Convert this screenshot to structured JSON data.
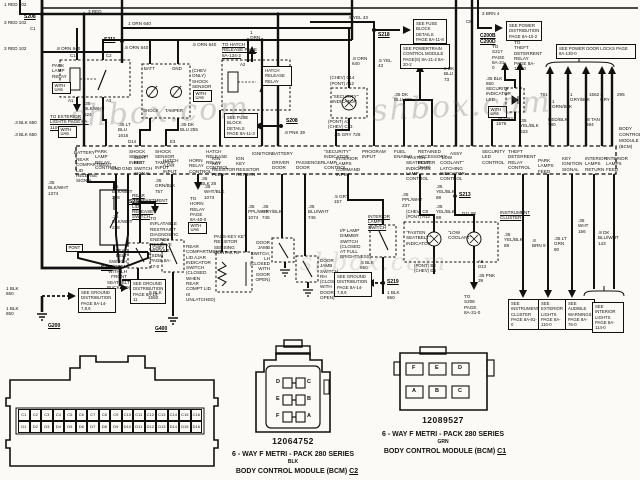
{
  "watermark": "shbox.com",
  "splices": {
    "s208a": "S208",
    "s208b": "S208",
    "s211": "S211",
    "s217": "S217",
    "s218": "S218",
    "s219": "S219",
    "s233": "S233",
    "s213": "S213",
    "g200": "G200",
    "g400": "G400"
  },
  "pin_ids": {
    "c1": "C1",
    "c1b": "C1",
    "c2": "C2",
    "a1": "A1",
    "a3": "A3",
    "a2": "A2",
    "d14": "D14",
    "e3": "E3",
    "c8": "C8",
    "c200b": "C200B",
    "c200d": "C200D",
    "chev_c14": "(CHEV) C14",
    "pont_a12": "(PONT) A12",
    "pont_a3": "(PONT) A3",
    "chev_c13": "(CHEV) C13",
    "chev_c8": "(CHEV) C8",
    "pont_a12b": "(PONT) A12",
    "d11_88": "D11  88",
    "pont_b3": "(PONT) B3",
    "chev_d4": "(CHEV) D4",
    "a5": "A5",
    "d13": "D13"
  },
  "wire_labels": {
    "red102_1": "1 RED 102",
    "red102_3a": "3 RED 102",
    "red102_3b": "3 RED 102",
    "red3": "3 RED",
    "orn640_1": "1 ORN 640",
    "orn640_8a": ".8 ORN 640",
    "orn640_8b": ".8 ORN 640",
    "orn640_5": ".5 ORN 640",
    "orn640_8c": ".8 ORN 640",
    "orn1": "1 ORN",
    "blkwht624": ".35 BLK/WHT 624",
    "blk650_3a": ".3 BLK 650",
    "blk650_3b": ".3 BLK 650",
    "ltblu1616": ".35 LT BLU 1616",
    "dkblu255": ".35 DK BLU 255",
    "pnk39_8": ".8 PNK 39",
    "yel43_5a": ".5 YEL 43",
    "yel43_5b": ".5 YEL 43",
    "gry728": ".35 GRY 728",
    "dkblu229": ".35 DK BLU 229",
    "dkblu73_2": "2 DK BLU 73",
    "brn4_3": "3 BRN 4",
    "blk650_35": ".35 BLK 650",
    "gry1579": ".35 GRY 1579",
    "yelblk633": ".35 YEL/BLK 633",
    "c781": "781",
    "ornblk1": "1 ORN/BLK",
    "redblk780": "RED/BLK 780",
    "gryblk1": "1 GRY/BLK",
    "c1562": "1562",
    "tan694": ".8 TAN 694",
    "gry1": "1 GRY",
    "c295": "295",
    "blkwht1374": ".35 BLK/WHT 1374",
    "blkwht238a": ".35 BLK/WHT 238",
    "blkwht238b": ".35 BLK/WHT 238",
    "grnblk757": ".35 GRN/BLK 757",
    "blk28": ".35 BLK 28",
    "whtblk1073": ".35 WHT/BLK 1073",
    "pplwht1074": ".35 PPL/WHT 1074",
    "gryblk745": ".35 GRY/BLK 745",
    "bluwht746": ".35 BLU/WHT 746",
    "gry157": ".5 GRY 157",
    "blk650_5a": ".5 BLK 650",
    "blk650_1a": "1 BLK 650",
    "blk650_1b": "1 BLK 650",
    "blk650_1c": "1 BLK 650",
    "blk1550": ".5 BLK 1550",
    "pplwht237": ".35 PPL/WHT 237",
    "yelblk88a": ".35 YEL/BLK 88",
    "yelblk88b": ".35 YEL/BLK 88",
    "yelblk88c": ".35 YEL/BLK 88",
    "pnk39": ".35 PNK 39",
    "brn9": ".8 BRN 9",
    "ltgrn80": ".35 LT GRN 80",
    "wht156": ".35 WHT 156",
    "dkbluwht143": ".8 DK BLU/WHT 143"
  },
  "notes": {
    "to_exterior_lights": "TO EXTERIOR LIGHTS PAGE 8A-110-0",
    "to_hatch_release": "TO HATCH RELEASE PAGE 8A-134-2",
    "fuse_block_a": "SEE FUSE BLOCK DETAILS PAGE 8A-11-3",
    "fuse_block_b": "SEE FUSE BLOCK DETAILS PAGE 8A-11-8",
    "powertrain": "SEE POWERTRAIN CONTROL MODULE PAGE(S) 8A-21-2  8A-20-2",
    "power_dist": "SEE POWER DISTRIBUTION PAGE 8A-10-2",
    "to_s217": "TO S217 PAGE 8A-31-0",
    "theft_relay": "TO THEFT DETERRENT RELAY PAGE 8A-133-0",
    "door_locks": "SEE POWER DOOR LOCKS PAGE 8A-130-0",
    "gnd_dist_a": "SEE GROUND DISTRIBUTION PAGE 8A-14-7,8,9",
    "gnd_dist_b": "SEE GROUND DISTRIBUTION PAGE 8A-14-11",
    "gnd_dist_c": "SEE GROUND DISTRIBUTION PAGE 8A-14-7,8,9",
    "to_sdm": "TO INFLATABLE RESTRAINT DIAGNOSTIC ENERGY RESERVE MODULE (SDM) PAGE 8A-47-0",
    "to_horn": "TO HORN RELAY PAGE 8A-40-0",
    "to_s208": "TO S208 PAGE 8A-31-0",
    "see_cluster": "SEE INSTRUMENT CLUSTER PAGE 8A-81-0",
    "see_ext_lights": "SEE EXTERIOR LIGHTS PAGE 8A-110-0",
    "see_audible": "SEE AUDIBLE WARNINGS PAGE 8A-76-0",
    "see_int_lights": "SEE INTERIOR LIGHTS PAGE 8A-114-0"
  },
  "components": {
    "park_lamp_relay": "PARK LAMP RELAY",
    "with_ua6": "WITH UA6",
    "shock_sensor": "(CHEV ONLY) SHOCK SENSOR",
    "batt": "BATT",
    "gnd": "GND",
    "shock": "SHOCK",
    "tamper": "TAMPER",
    "hatch_relay": "HATCH RELEASE RELAY",
    "security_indicator": "\"SECURITY\" INDICATOR",
    "security_led": "SECURITY INDICATOR LED",
    "rear_release_switch": "REAR COMPARTMENT LID RELEASE SWITCH",
    "pont": "PONT",
    "chev": "CHEV",
    "seat_belt_switch": "SEAT BELT SWITCH (OPEN WITH LH FRONT SEATBELT BUCKLED)",
    "rear_ajar_switch": "REAR COMPARTMENT LID AJAR INDICATOR SWITCH (CLOSED WHEN REAR COMPT LID IS UNLATCHED)",
    "passkey": "PASS-KEY KEY RESISTOR SENSING CONTACTS",
    "door_jamb_lh": "DOOR JAMB SWITCH, LH (CLOSED WITH DOOR OPEN)",
    "door_jamb_rh": "DOOR JAMB SWITCH, RH (CLOSED WITH DOOR OPEN)",
    "interior_lamps_switch": "INTERIOR LAMPS SWITCH",
    "dimmer": "I/P LAMP DIMMER SWITCH (CLOSED AT FULL BRIGHTNESS)",
    "instrument_cluster": "INSTRUMENT CLUSTER",
    "fasten_seatbelt": "\"FASTEN SEATBELT\" INDICATOR",
    "low_coolant": "\"LOW COOLANT\""
  },
  "bcm": {
    "name_lines": [
      "BODY",
      "CONTROL",
      "MODULE",
      "(BCM)"
    ],
    "top_pins": [
      "BATTERY",
      "PARK LAMP RELAY CONTROL",
      "SHOCK SENSOR INPUT",
      "SHOCK SENSOR TAMPER INPUT",
      "HATCH RELEASE RELAY CONTROL",
      "IGNITION",
      "BATTERY",
      "\"SECURITY\" INDICATOR LAMP CONTROL",
      "PROGRAM INPUT",
      "FUEL ENABLE",
      "RETAINED ACCESSORY POWER (RAP)",
      "ASSY",
      "SECURITY LED CONTROL",
      "THEFT DETERRENT RELAY CONTROL"
    ],
    "bottom_pins": [
      "REAR COMPARTMENT LID RELEASE SIGNAL",
      "GND",
      "GND",
      "SEAT BELT SWITCH SIGNAL",
      "HATCH AJAR INPUT",
      "HORN RELAY CONTROL",
      "IGN KEY RESISTOR FEED",
      "IGN KEY RESISTOR RETURN",
      "DRIVER DOOR",
      "PASSENGER DOOR",
      "INTERIOR LAMPS COMMAND INPUT",
      "\"FASTEN SEATBELT\" INDICATOR LAMP CONTROL",
      "\"LOW COOLANT\" LATCHING INDICATOR CONTROL",
      "PARK LAMPS FEED",
      "KEY IGNITION SIGNAL",
      "INTERIOR LAMPS RETURN",
      "INTERIOR LAMPS FEED"
    ]
  },
  "connector_32": {
    "row_c": [
      "C1",
      "C2",
      "C3",
      "C4",
      "C5",
      "C6",
      "C7",
      "C8",
      "C9",
      "C10",
      "C11",
      "C12",
      "C13",
      "C14",
      "C15",
      "C16"
    ],
    "row_d": [
      "D1",
      "D2",
      "D3",
      "D4",
      "D5",
      "D6",
      "D7",
      "D8",
      "D9",
      "D10",
      "D11",
      "D12",
      "D13",
      "D14",
      "D15",
      "D16"
    ]
  },
  "connector_c2": {
    "part_number": "12064752",
    "series": "6 - WAY F METRI - PACK 280 SERIES",
    "color": "BLK",
    "module": "BODY CONTROL MODULE (BCM)",
    "designator": "C2",
    "pins": [
      "D",
      "C",
      "E",
      "B",
      "F",
      "A"
    ]
  },
  "connector_c1": {
    "part_number": "12089527",
    "series": "6 - WAY F METRI - PACK 280 SERIES",
    "color": "GRN",
    "module": "BODY CONTROL MODULE (BCM)",
    "designator": "C1",
    "pins_top": [
      "F",
      "E",
      "D"
    ],
    "pins_bottom": [
      "A",
      "B",
      "C"
    ]
  }
}
